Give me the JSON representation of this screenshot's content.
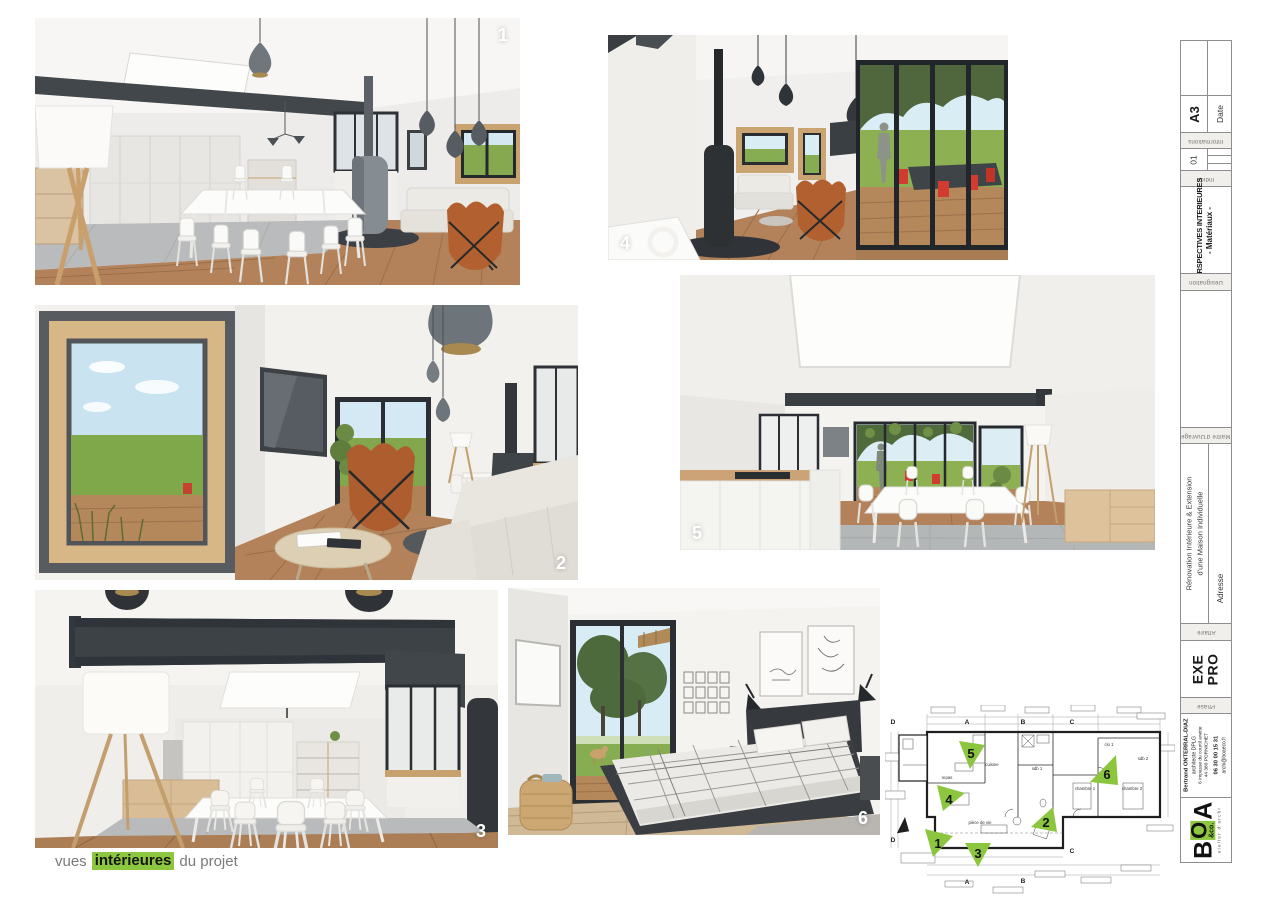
{
  "caption": {
    "prefix": "vues",
    "highlight": "intérieures",
    "suffix": "du projet"
  },
  "renders": [
    {
      "label": "1"
    },
    {
      "label": "2"
    },
    {
      "label": "3"
    },
    {
      "label": "4"
    },
    {
      "label": "5"
    },
    {
      "label": "6"
    }
  ],
  "colors": {
    "accent_green": "#8dc63f",
    "beam_dark": "#3e4347",
    "wood_floor": "#b3825a",
    "leather_chair": "#b2602f",
    "outdoor_chair_red": "#d23b2f"
  },
  "title_block": {
    "format": "A3",
    "date_label": "Date",
    "informations_label": "Informations",
    "indice_value": "01",
    "indice_label": "Indice",
    "designation_line1": "PERSPECTIVES INTERIEURES",
    "designation_line2": "- Matériaux -",
    "designation_label": "Désignation",
    "owner_label": "Maître d'Ouvrage",
    "project_line1": "Rénovation Intérieure & Extension",
    "project_line2": "d'une Maison Individuelle",
    "address_label": "Adresse",
    "affaire_label": "Affaire",
    "phase_line1": "EXE",
    "phase_line2": "PRO",
    "phase_label": "Phase",
    "architect_name": "Bertrand ONTERRAL-DIAZ",
    "architect_title": "architecte DPLG",
    "address_line1": "6 impasse du courtil anette",
    "address_line2": "44 380 PORNICHET",
    "phone": "06 30 00 15 31",
    "email": "archi@boaeco.fr",
    "logo": {
      "b": "B",
      "o": "O",
      "a": "A",
      "co": "&co.",
      "tagline": "atelier d'archi"
    }
  },
  "plan": {
    "rooms": [
      {
        "name": "cuisine"
      },
      {
        "name": "repas"
      },
      {
        "name": "pièce de vie"
      },
      {
        "name": "sdb 1"
      },
      {
        "name": "clo 1"
      },
      {
        "name": "chambre 1"
      },
      {
        "name": "chambre 2"
      },
      {
        "name": "sdb 2"
      }
    ],
    "sections": {
      "a": "A",
      "b": "B",
      "c": "C",
      "d": "D"
    },
    "markers": [
      {
        "n": "1"
      },
      {
        "n": "2"
      },
      {
        "n": "3"
      },
      {
        "n": "4"
      },
      {
        "n": "5"
      },
      {
        "n": "6"
      }
    ]
  }
}
